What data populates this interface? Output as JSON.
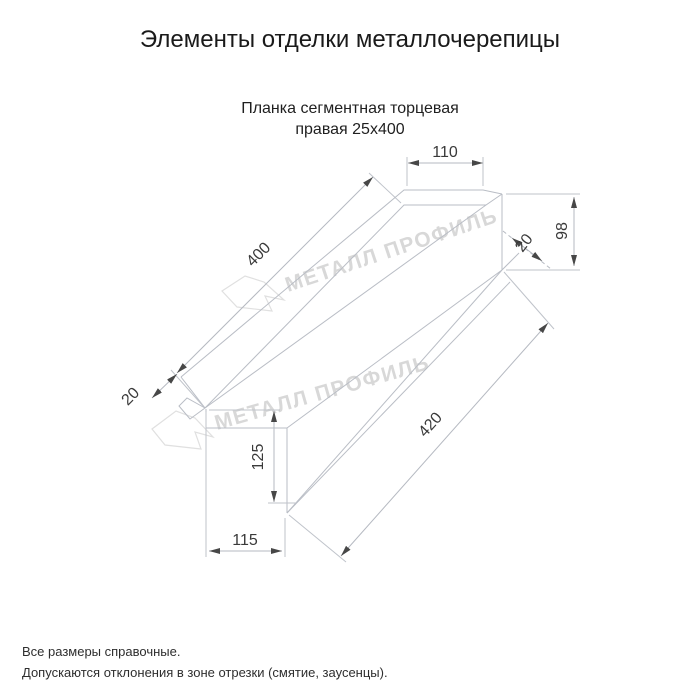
{
  "page": {
    "title": "Элементы отделки металлочерепицы",
    "subtitle_line1": "Планка сегментная торцевая",
    "subtitle_line2": "правая 25х400",
    "footer_line1": "Все размеры справочные.",
    "footer_line2": "Допускаются отклонения в зоне отрезки (смятие, заусенцы)."
  },
  "drawing": {
    "type": "technical-dimension-drawing",
    "part_name": "Планка сегментная торцевая правая 25х400",
    "dimensions": {
      "top_width": "110",
      "segment_length": "400",
      "end_height": "98",
      "end_lip": "20",
      "left_lip": "20",
      "bottom_length": "420",
      "left_height": "125",
      "bottom_width": "115"
    },
    "colors": {
      "line": "#b9bdc5",
      "dim_text": "#3a3a3a",
      "watermark": "#d8d8d8",
      "title_text": "#1a1a1a"
    }
  },
  "watermark": {
    "text": "МЕТАЛЛ ПРОФИЛЬ"
  }
}
